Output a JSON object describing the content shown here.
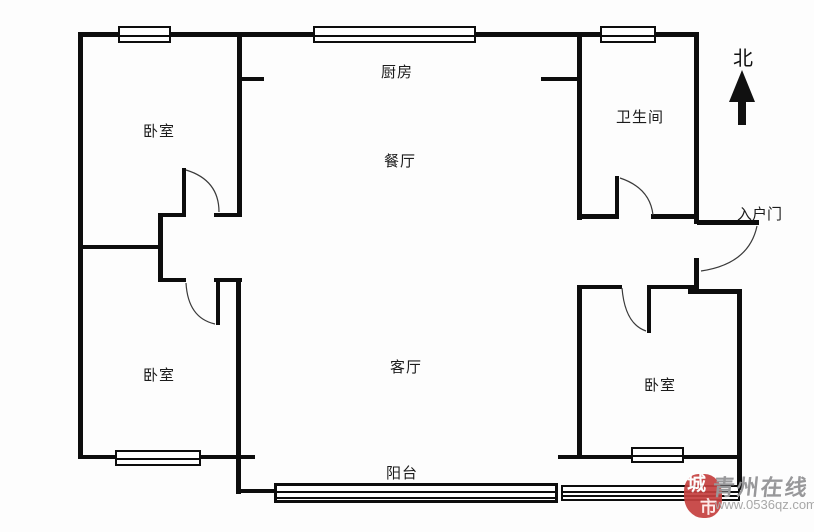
{
  "rooms": {
    "kitchen": "厨房",
    "bathroom": "卫生间",
    "bedroom_top_left": "卧室",
    "dining": "餐厅",
    "living": "客厅",
    "bedroom_bottom_left": "卧室",
    "bedroom_bottom_right": "卧室",
    "balcony": "阳台"
  },
  "entrance": {
    "label": "入户门"
  },
  "compass": {
    "north_label": "北"
  },
  "watermark": {
    "site_name": "青州在线",
    "url": "www.0536qz.com",
    "logo_text_top": "城",
    "logo_text_bottom": "市",
    "logo_color": "#c5403f",
    "text_color": "#98989a"
  },
  "colors": {
    "wall": "#0d0d0d",
    "door_arc": "#3a3a3a",
    "background": "#fdfdfd"
  }
}
